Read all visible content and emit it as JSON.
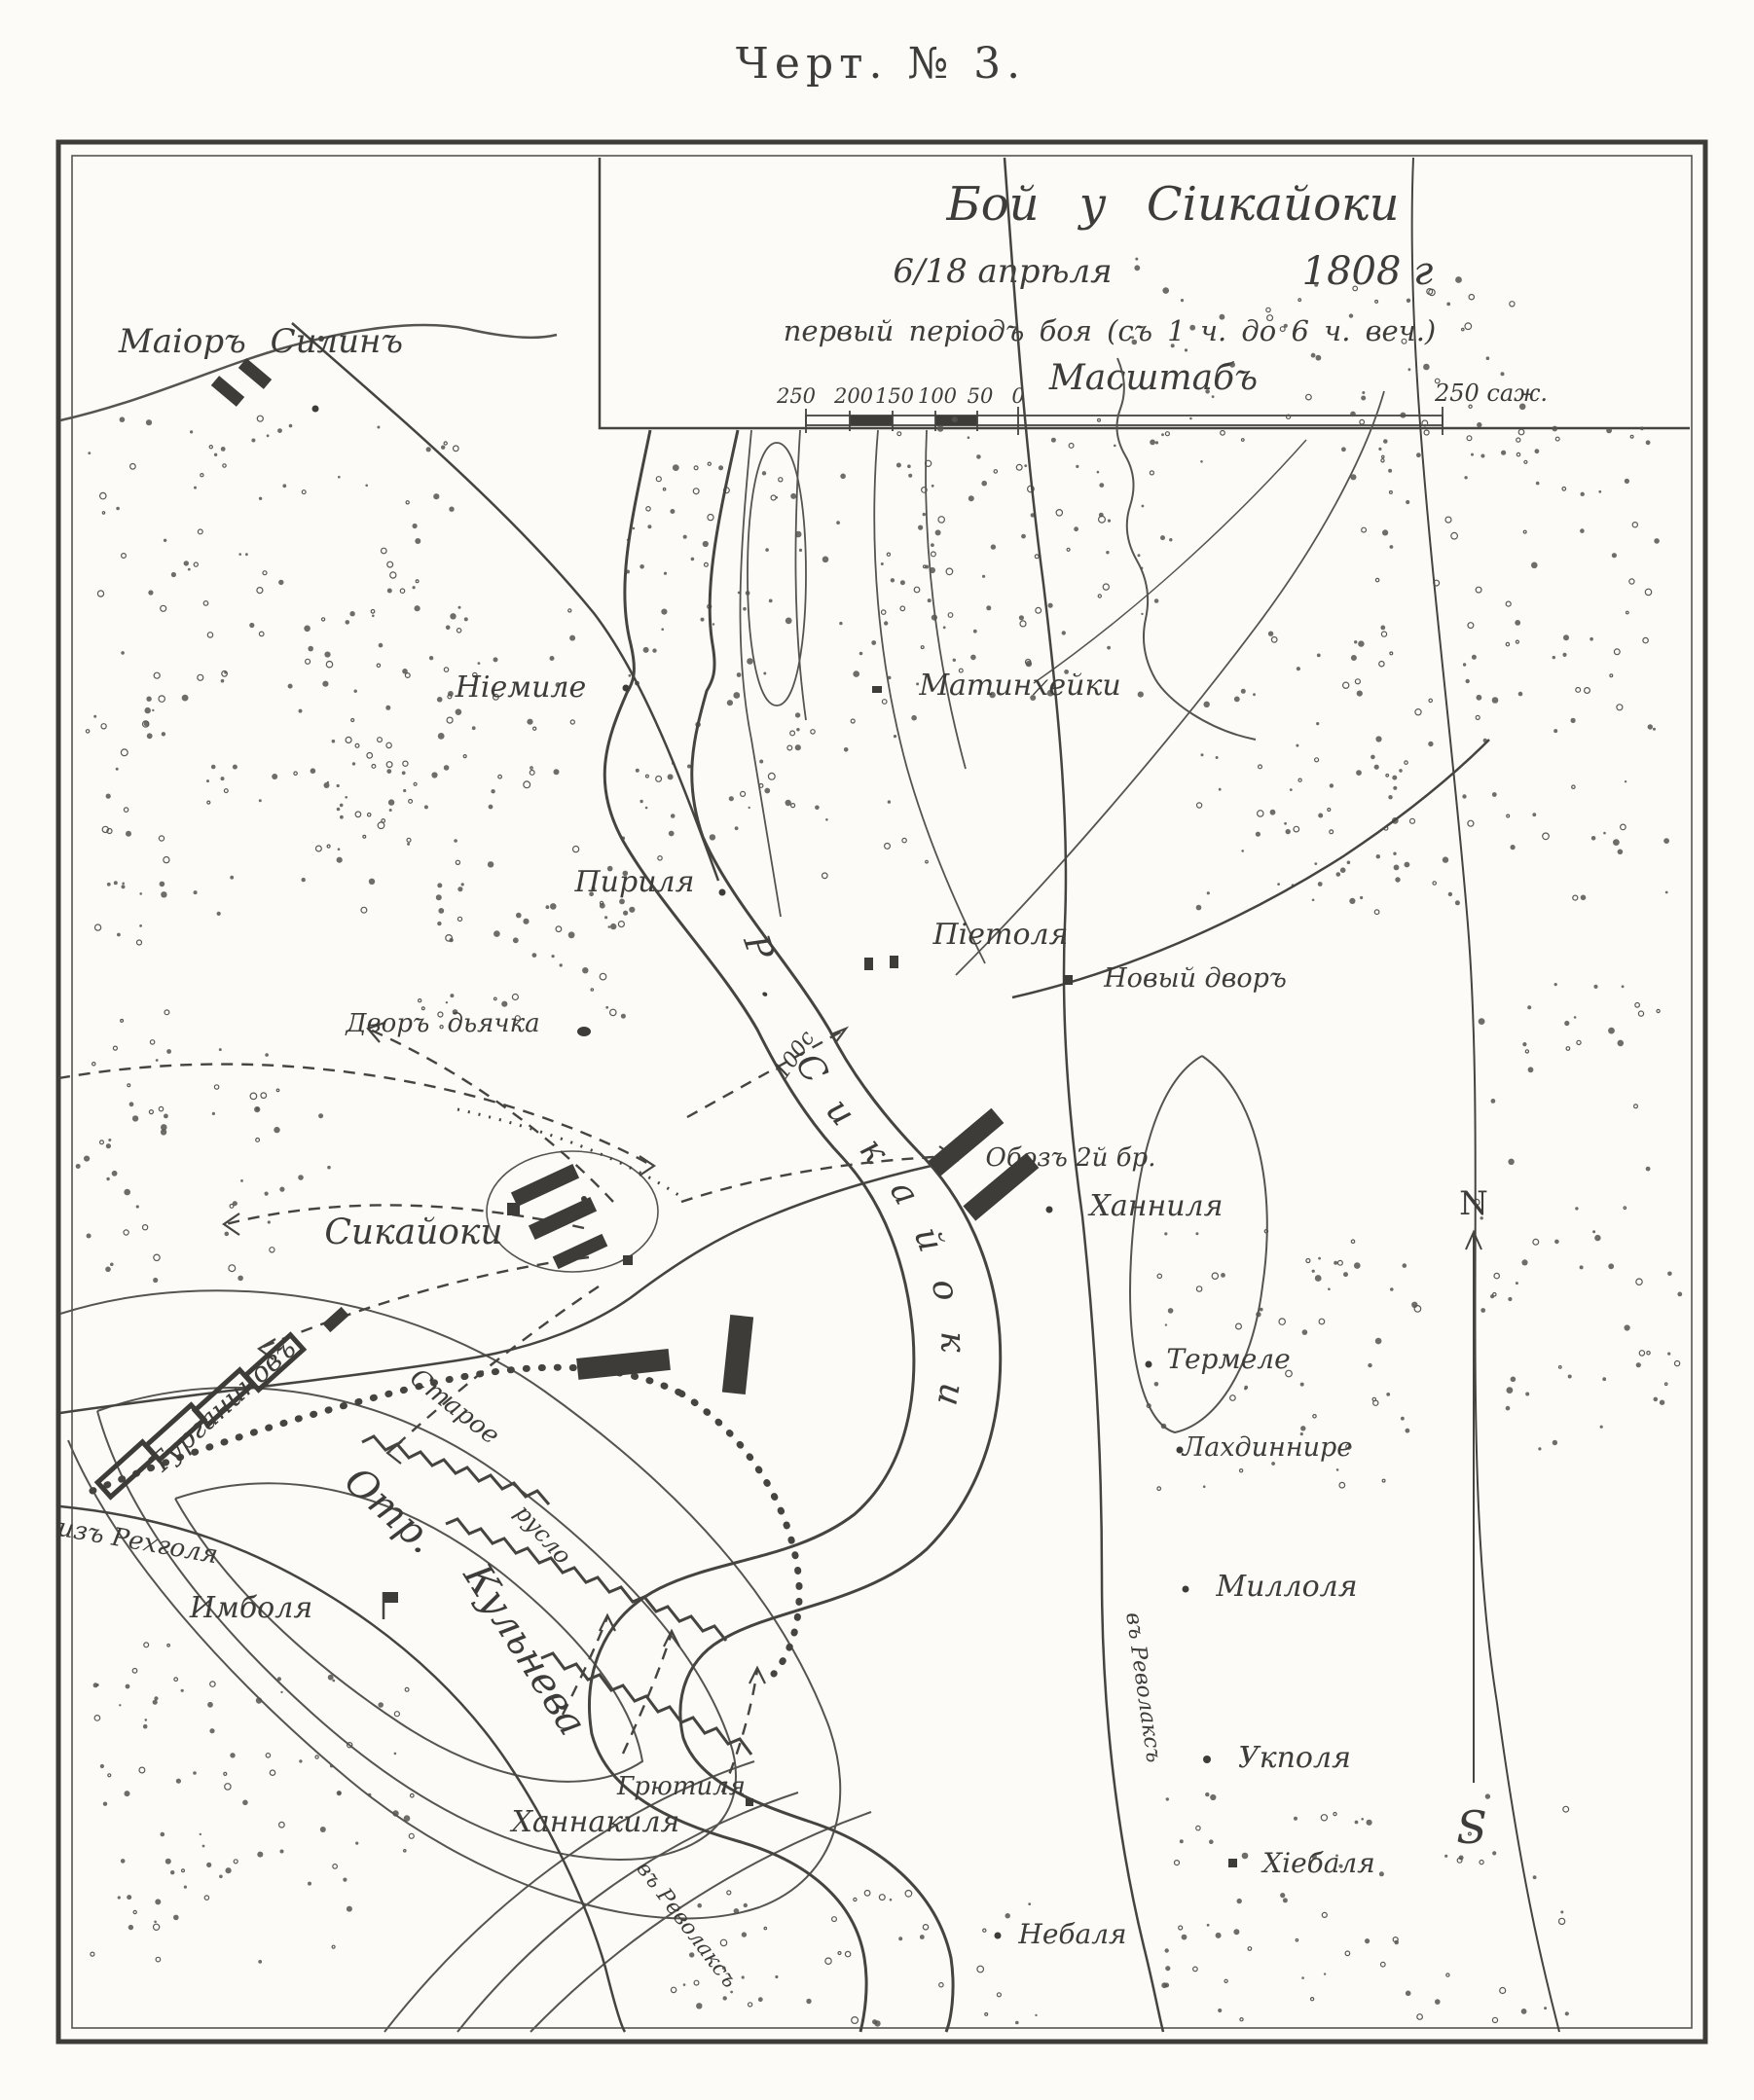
{
  "figure": {
    "caption": "Черт. № 3."
  },
  "title_block": {
    "title": "Бой у Сіикайоки",
    "date": "6/18 апрѣля",
    "year": "1808 г",
    "subtitle": "первый періодъ боя (съ 1 ч. до 6 ч. веч.)",
    "scale_heading": "Масштабъ",
    "scale_ticks": [
      "250",
      "200",
      "150",
      "100",
      "50",
      "0"
    ],
    "scale_end_label": "250 саж."
  },
  "compass": {
    "north": "N",
    "south": "S"
  },
  "river": {
    "label": "Р. Сикайоки"
  },
  "annotations": {
    "commander_nw": "Маіоръ Силинъ",
    "column_w": "Турганиновъ",
    "detachment_1": "Отр.",
    "detachment_2": "Кульнева",
    "old_channel_1": "Старое",
    "old_channel_2": "русло",
    "width_note": "100с",
    "baggage": "Обозъ 2й бр.",
    "road_from_w": "изъ Рехголя",
    "road_to_s": "въ Револаксъ",
    "road_to_se": "въ Револаксъ"
  },
  "places": [
    "Ніемиле",
    "Матинхейки",
    "Пириля",
    "Піетоля",
    "Новый дворъ",
    "Дворъ дьячка",
    "Сикайоки",
    "Ханниля",
    "Термеле",
    "Лахдиннире",
    "Миллоля",
    "Укполя",
    "Хіебаля",
    "Небаля",
    "Имболя",
    "Грютиля",
    "Ханнакиля"
  ]
}
